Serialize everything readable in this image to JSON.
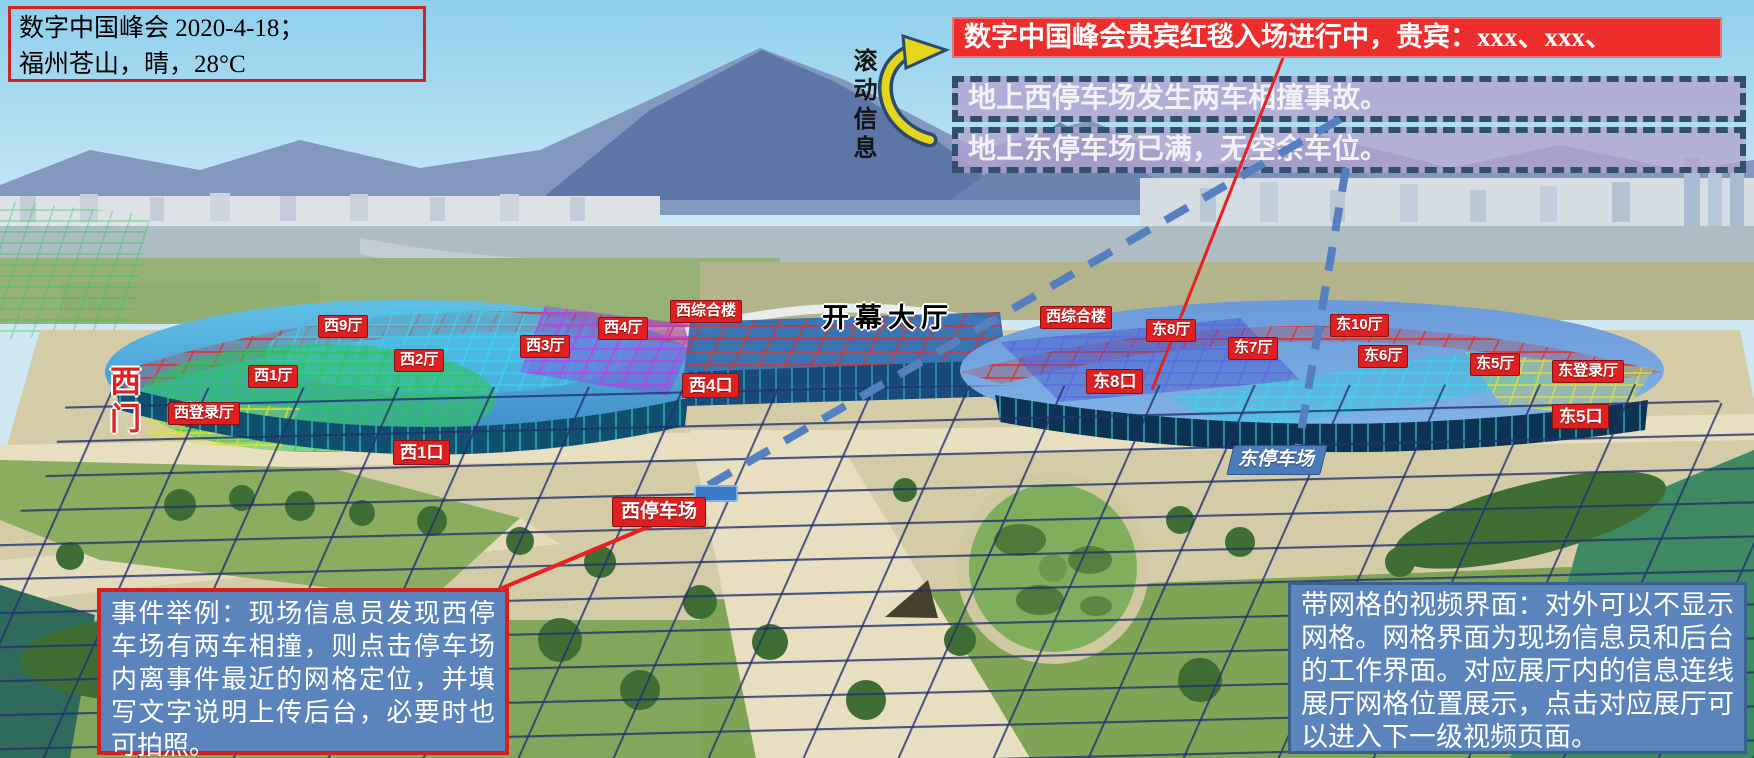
{
  "header": {
    "info_box": {
      "line1": "数字中国峰会 2020-4-18；",
      "line2": "福州苍山，晴，28°C"
    },
    "scroll_label": "滚动信息",
    "ticker": {
      "headline": "数字中国峰会贵宾红毯入场进行中，贵宾：xxx、xxx、",
      "messages": [
        "地上西停车场发生两车相撞事故。",
        "地上东停车场已满，无空余车位。"
      ]
    }
  },
  "labels": {
    "west9": "西9厅",
    "west2": "西2厅",
    "west1": "西1厅",
    "westLogin": "西登录厅",
    "west3": "西3厅",
    "west4": "西4厅",
    "westComplexW": "西综合楼",
    "westComplexE": "西综合楼",
    "east8": "东8厅",
    "east7": "东7厅",
    "east10": "东10厅",
    "east6": "东6厅",
    "east5": "东5厅",
    "eastLogin": "东登录厅",
    "gateW4": "西4口",
    "gateW1": "西1口",
    "gateE8": "东8口",
    "gateE5": "东5口",
    "openingHall": "开幕大厅",
    "westGate": "西门",
    "westParking": "西停车场",
    "eastParking": "东停车场"
  },
  "notes": {
    "event_note": "事件举例：现场信息员发现西停车场有两车相撞，则点击停车场内离事件最近的网格定位，并填写文字说明上传后台，必要时也可拍照。",
    "grid_note": "带网格的视频界面：对外可以不显示网格。网格界面为现场信息员和后台的工作界面。对应展厅内的信息连线展厅网格位置展示，点击对应展厅可以进入下一级视频页面。"
  },
  "colors": {
    "accent_red": "#e02020",
    "ticker_red": "#ee2d2d",
    "dashed_fill": "#b2a2d0",
    "dashed_border": "#32506e",
    "note_fill": "#5b84bc",
    "note_border_red": "#d42020",
    "note_border_blue": "#39618f",
    "arrow_yellow": "#e6d51f",
    "parking_blue": "#4a7ab8",
    "grid_navy": "#223070"
  }
}
